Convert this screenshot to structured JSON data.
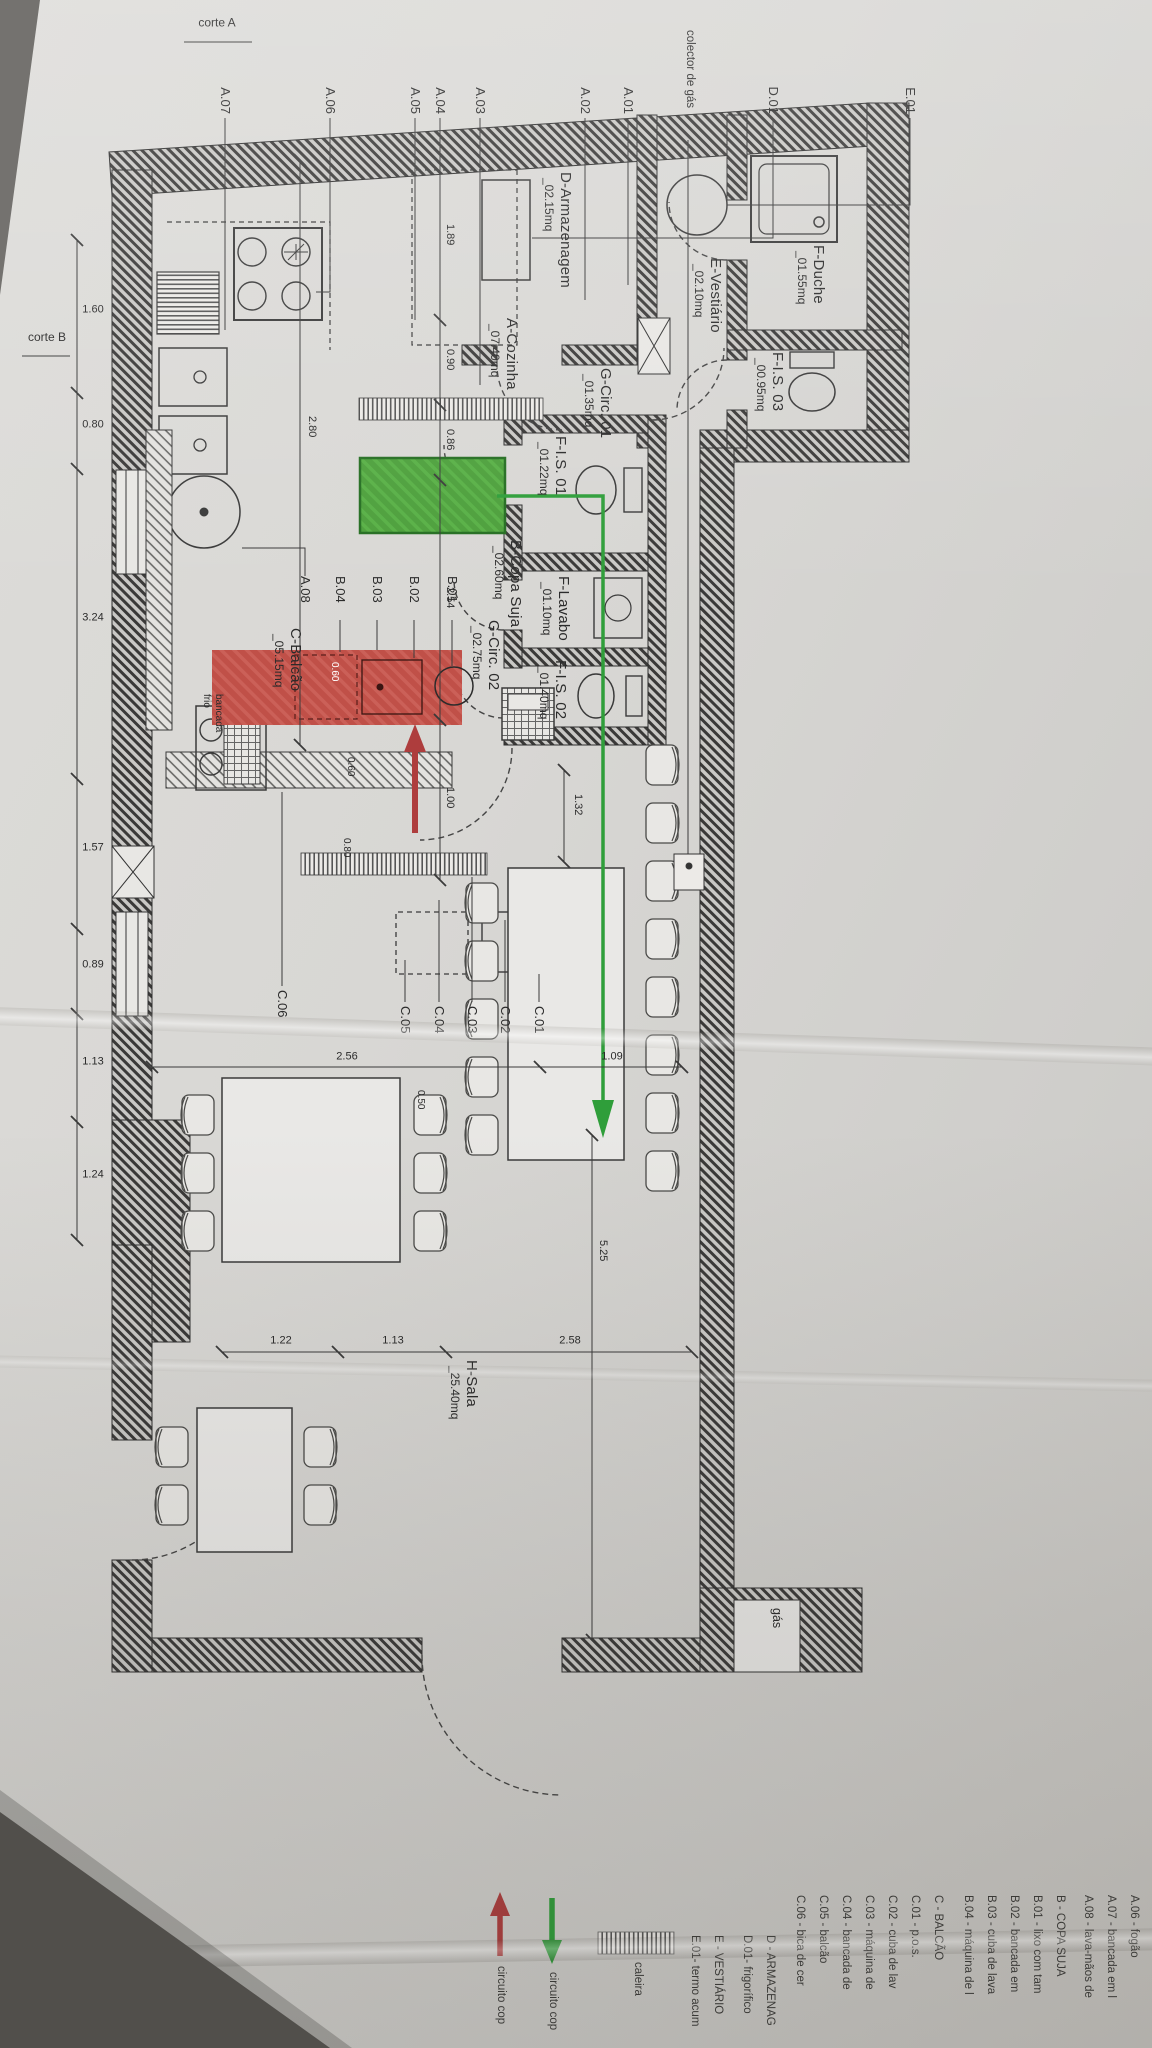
{
  "rooms": [
    {
      "name": "F-Duche",
      "area": "_01.55mq"
    },
    {
      "name": "F-I.S. 03",
      "area": "_00.95mq"
    },
    {
      "name": "E-Vestiário",
      "area": "_02.10mq"
    },
    {
      "name": "D-Armazenagem",
      "area": "_02.15mq"
    },
    {
      "name": "G-Circ. 01",
      "area": "_01.35mq"
    },
    {
      "name": "F-I.S. 01",
      "area": "_01.22mq"
    },
    {
      "name": "F-Lavabo",
      "area": "_01.10mq"
    },
    {
      "name": "G-Circ. 02",
      "area": "_02.75mq"
    },
    {
      "name": "F-I.S. 02",
      "area": "_01.40mq"
    },
    {
      "name": "A-Cozinha",
      "area": "_07.40mq"
    },
    {
      "name": "B-Copa Suja",
      "area": "_02.60mq"
    },
    {
      "name": "C-Balcão",
      "area": "_05.15mq"
    },
    {
      "name": "H-Sala",
      "area": "_25.40mq"
    }
  ],
  "leaders": {
    "left": [
      "E.01",
      "D.01",
      "A.01",
      "A.02",
      "A.03",
      "A.04",
      "A.05",
      "A.06",
      "A.07"
    ],
    "colector": "colector de gás",
    "copa": [
      "B.01",
      "B.02",
      "B.03",
      "B.04",
      "A.08"
    ],
    "balcao": [
      "C.01",
      "C.02",
      "C.03",
      "C.04",
      "C.05",
      "C.06"
    ]
  },
  "dims": {
    "bottom": [
      "1.60",
      "0.80",
      "3.24",
      "1.57",
      "0.89",
      "1.13",
      "1.24"
    ],
    "right": [
      "2.58",
      "1.13",
      "1.22"
    ],
    "kitchen": [
      "1.89",
      "0.90",
      "0.86",
      "2.54",
      "1.00"
    ],
    "sala_v": [
      "1.09",
      "2.56"
    ],
    "sala_h": "5.25",
    "depth": "2.80",
    "small": [
      "0.60",
      "0.60",
      "0.80",
      "0.50",
      "1.32"
    ]
  },
  "annotations": {
    "gas": "gás",
    "bancada_line1": "bancada",
    "bancada_line2": "frio",
    "corte_a": "corte A",
    "corte_b": "corte B"
  },
  "legend": {
    "a": [
      "A.06 - fogão",
      "A.07 - bancada em l",
      "A.08 - lava-mãos de"
    ],
    "b": [
      "B - COPA SUJA",
      "B.01 - lixo com tam",
      "B.02 - bancada em",
      "B.03 - cuba de lava",
      "B.04 - máquina de l"
    ],
    "c": [
      "C - BALCÃO",
      "C.01 - p.o.s.",
      "C.02 - cuba de lav",
      "C.03 - máquina de",
      "C.04 - bancada de",
      "C.05 - balcão",
      "C.06 - bica de cer"
    ],
    "d": [
      "D - ARMAZENAG",
      "D.01- frigorífico"
    ],
    "e": [
      "E - VESTIÁRIO",
      "E.01- termo acum"
    ],
    "caleira": "caleira",
    "circuito_red": "circuito cop",
    "circuito_green": "circuito cop"
  },
  "colors": {
    "highlight_green": "#4da03c",
    "highlight_red": "#c05048",
    "arrow_green": "#2f9e3a",
    "arrow_red": "#ae3d3d"
  }
}
